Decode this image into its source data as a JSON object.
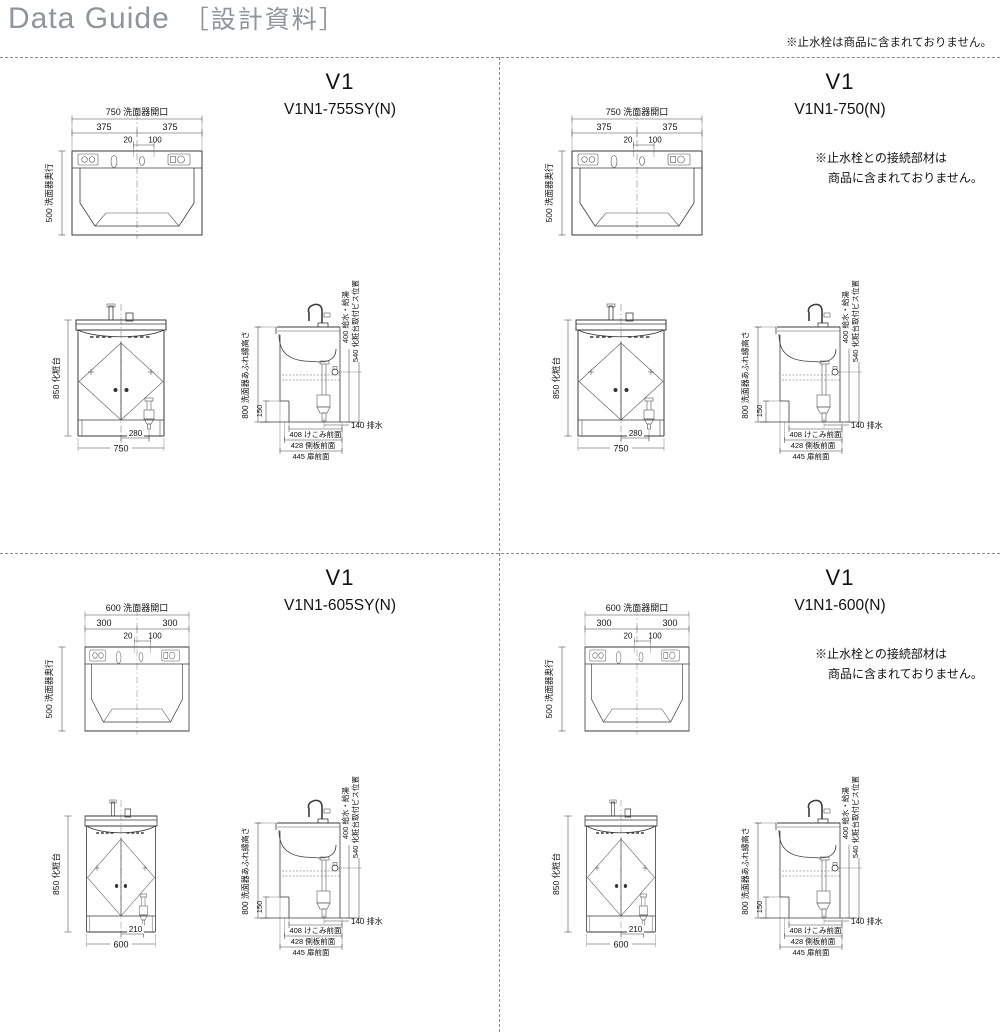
{
  "header": {
    "title_en": "Data Guide",
    "title_ja": "［設計資料］",
    "note": "※止水栓は商品に含まれておりません。"
  },
  "labels": {
    "plan_depth": "500 洗面器奥行",
    "plan_dim_small": "20",
    "plan_dim_small2": "100",
    "front_height": "850 化粧台",
    "side_overflow_height": "800 洗面器あふれ縁高さ",
    "side_kick_height": "150",
    "side_supply": "400 給水・給湯",
    "side_screw": "540 化粧台取付ビス位置",
    "side_drain": "140 排水",
    "side_kick_front": "408 けこみ前面",
    "side_panel_front": "428 側板前面",
    "side_door_front": "445 扉前面"
  },
  "units": [
    {
      "series": "V1",
      "model": "V1N1-755SY(N)",
      "note1": "",
      "note2": "",
      "plan_width": "750 洗面器開口",
      "plan_half_left": "375",
      "plan_half_right": "375",
      "front_width": "750",
      "front_drain_offset": "280"
    },
    {
      "series": "V1",
      "model": "V1N1-750(N)",
      "note1": "※止水栓との接続部材は",
      "note2": "商品に含まれておりません。",
      "plan_width": "750 洗面器開口",
      "plan_half_left": "375",
      "plan_half_right": "375",
      "front_width": "750",
      "front_drain_offset": "280"
    },
    {
      "series": "V1",
      "model": "V1N1-605SY(N)",
      "note1": "",
      "note2": "",
      "plan_width": "600 洗面器開口",
      "plan_half_left": "300",
      "plan_half_right": "300",
      "front_width": "600",
      "front_drain_offset": "210"
    },
    {
      "series": "V1",
      "model": "V1N1-600(N)",
      "note1": "※止水栓との接続部材は",
      "note2": "商品に含まれておりません。",
      "plan_width": "600 洗面器開口",
      "plan_half_left": "300",
      "plan_half_right": "300",
      "front_width": "600",
      "front_drain_offset": "210"
    }
  ]
}
